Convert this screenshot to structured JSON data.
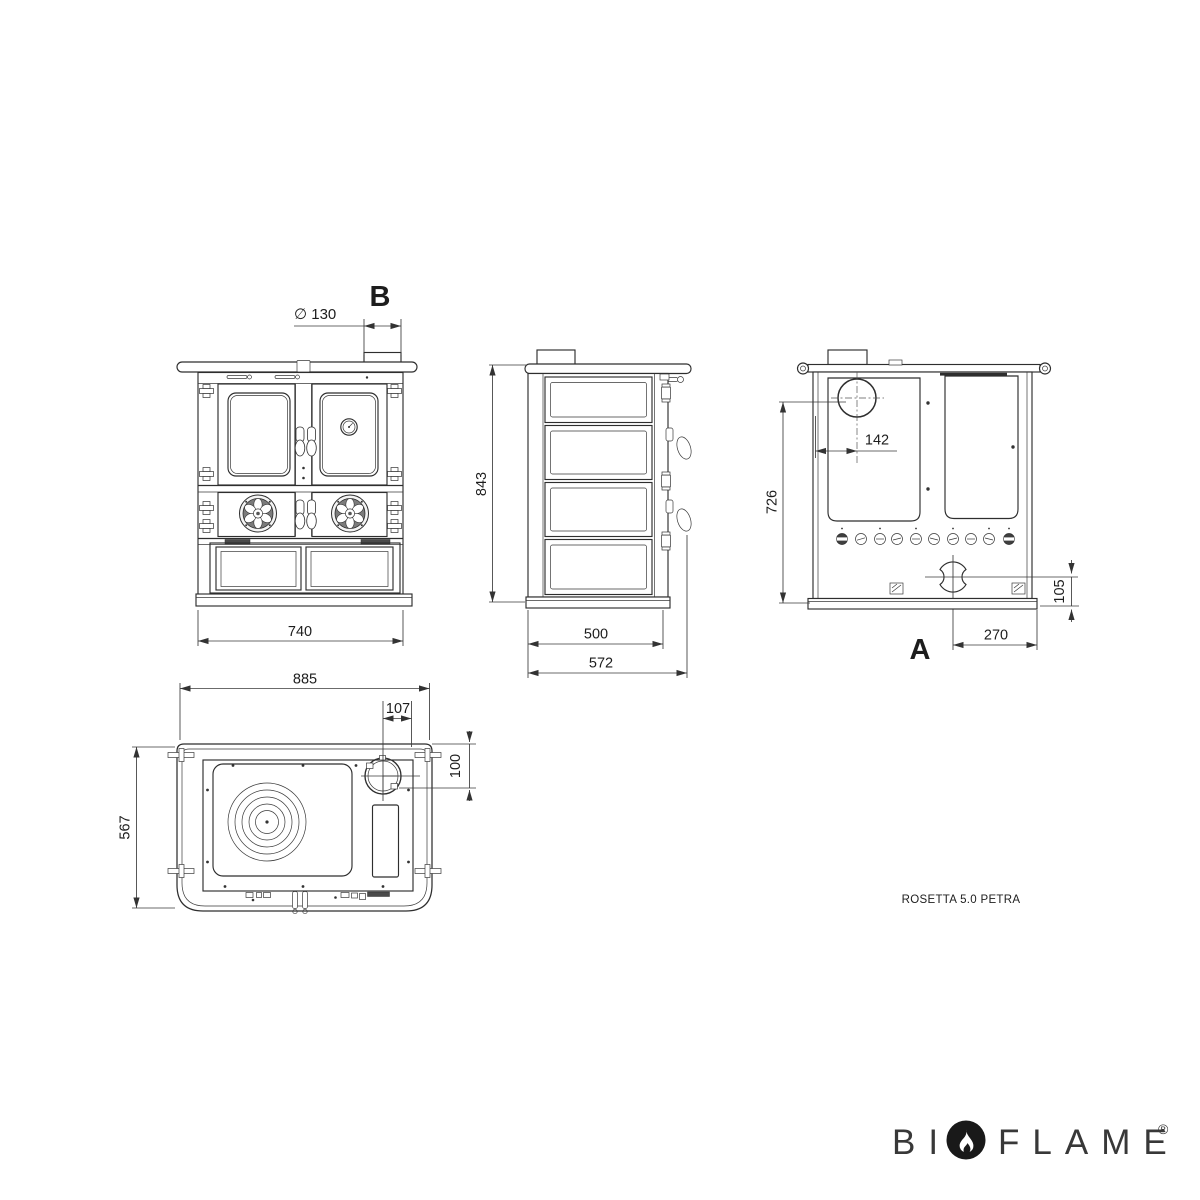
{
  "views": {
    "front": {
      "label": "B",
      "dim_flue_diameter": "∅ 130",
      "dim_width": "740"
    },
    "side": {
      "dim_height": "843",
      "dim_depth_body": "500",
      "dim_depth_overall": "572"
    },
    "rear": {
      "label": "A",
      "dim_flue_offset": "142",
      "dim_flue_height": "726",
      "dim_outlet_height": "105",
      "dim_outlet_offset": "270"
    },
    "top": {
      "dim_width_overall": "885",
      "dim_flue_offset": "107",
      "dim_flue_from_edge": "100",
      "dim_depth": "567"
    }
  },
  "model_label": "ROSETTA 5.0 PETRA",
  "logo": {
    "prefix": "BI",
    "suffix": "FLAME",
    "registered": "®"
  },
  "colors": {
    "background": "#ffffff",
    "line": "#2e2e2e",
    "dimension": "#3a3a3a",
    "logo_text": "#383838",
    "flame_badge": "#191919"
  }
}
